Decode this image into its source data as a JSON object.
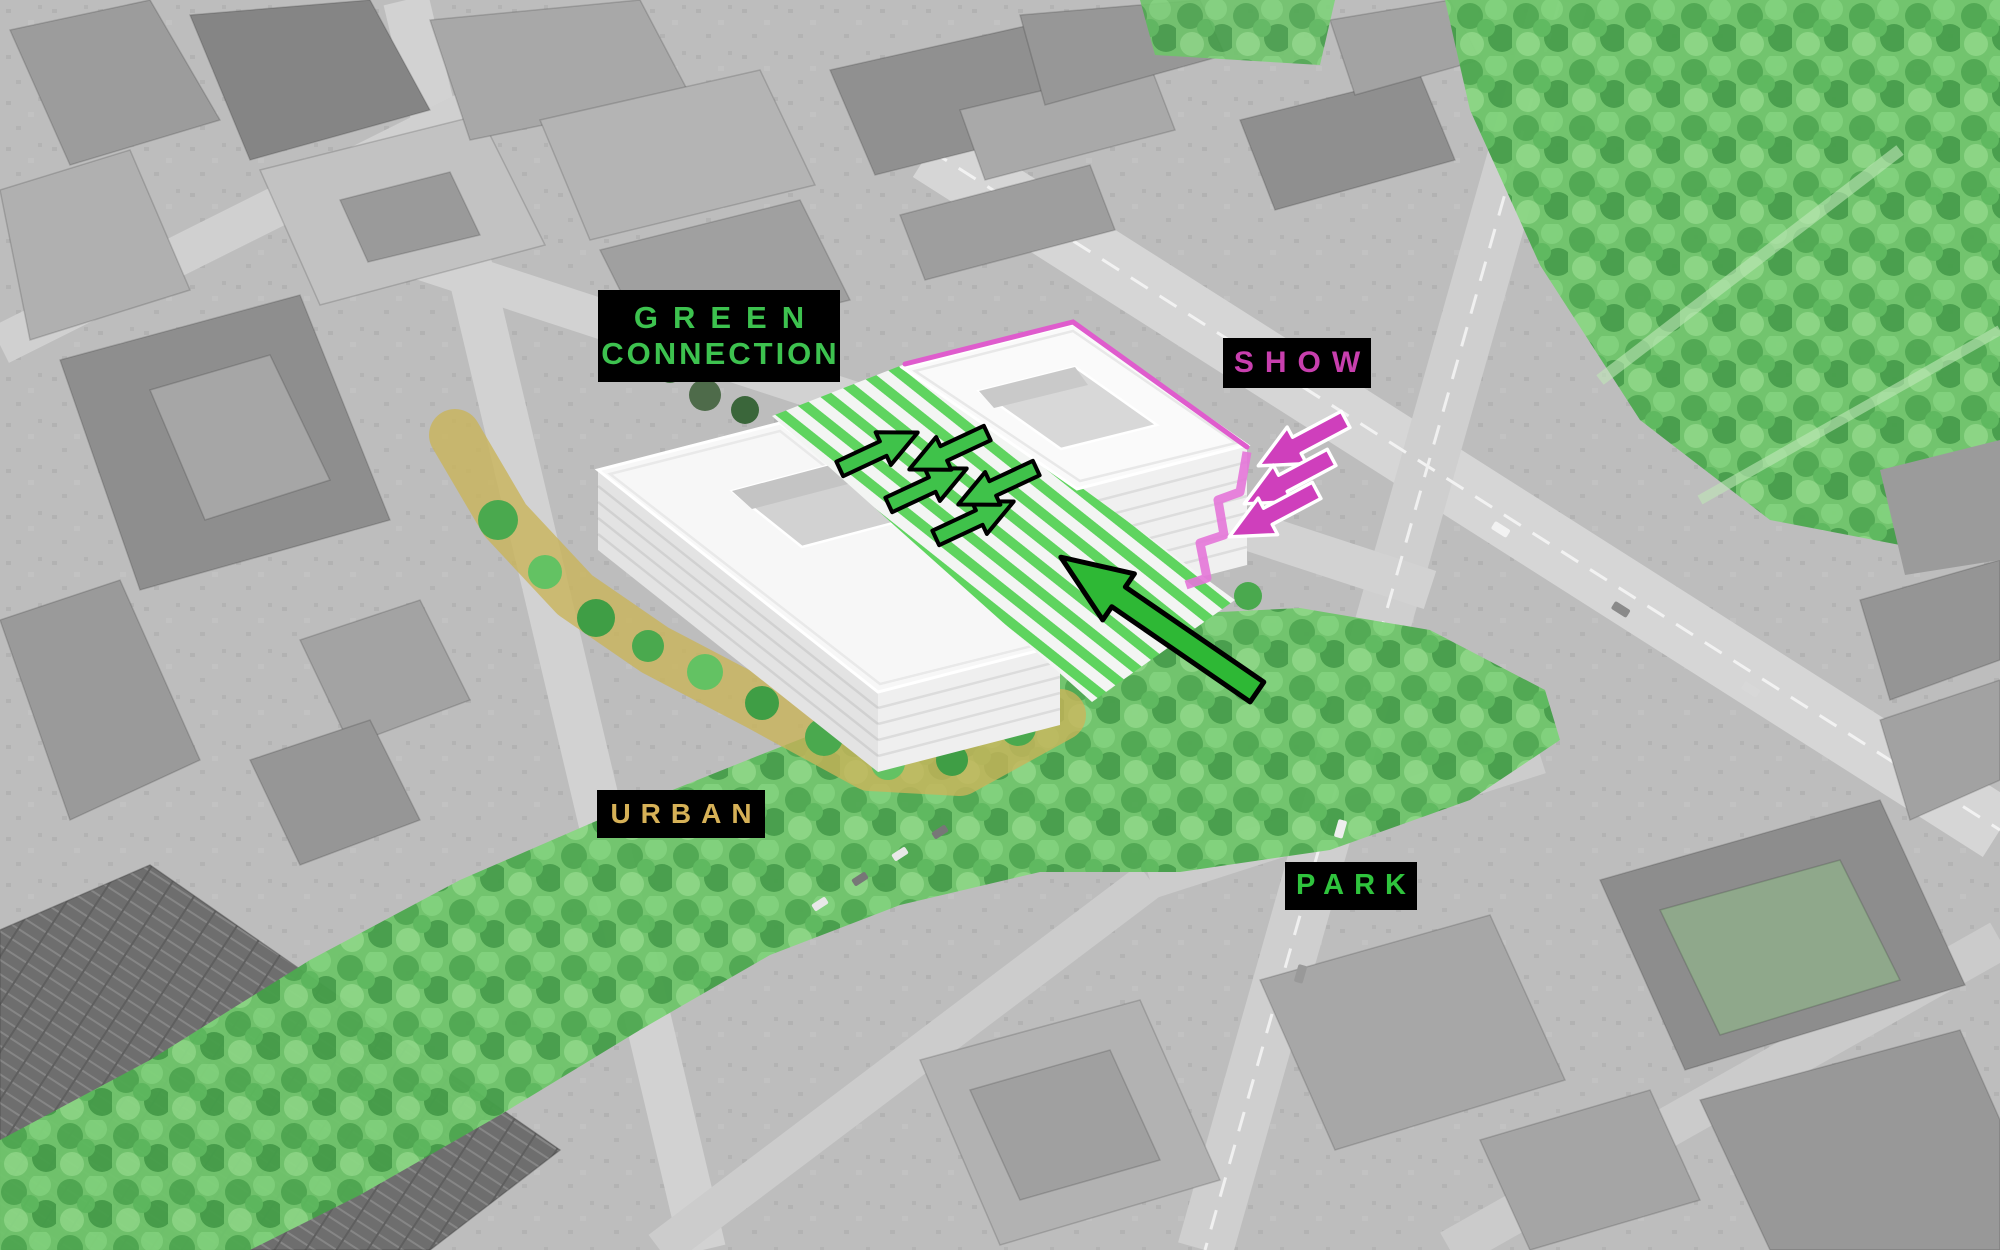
{
  "labels": {
    "green_connection": {
      "line1": "GREEN",
      "line2": "CONNECTION",
      "color": "#3dc24f",
      "background": "#000000"
    },
    "show": {
      "text": "SHOW",
      "color": "#c83fae",
      "background": "#000000"
    },
    "urban": {
      "text": "URBAN",
      "color": "#d6b157",
      "background": "#000000"
    },
    "park": {
      "text": "PARK",
      "color": "#2fc43d",
      "background": "#000000"
    }
  },
  "overlay_colors": {
    "terrace_green": "#5fd45f",
    "show_magenta": "#df5ccd",
    "urban_yellow": "#c9b45a",
    "park_green": "#66bf63",
    "flow_arrow_green": "#3fc24a",
    "main_access_arrow_green": "#2eb835",
    "arrow_outline_black": "#000000",
    "entry_arrow_outline_white": "#ffffff"
  },
  "icons": {
    "flow_arrows_up_right_count": 3,
    "flow_arrows_down_left_count": 2,
    "entry_arrows_magenta_count": 3,
    "main_access_arrow_count": 1
  }
}
